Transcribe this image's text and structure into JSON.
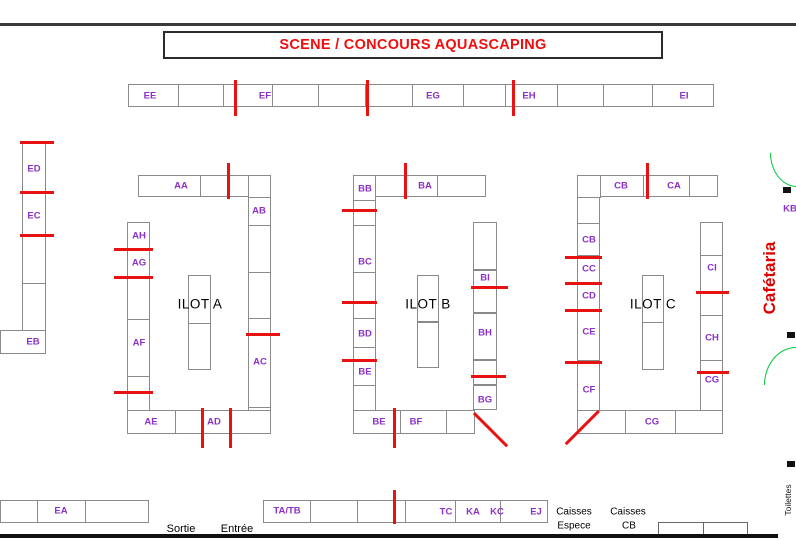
{
  "title": "SCENE / CONCOURS AQUASCAPING",
  "zones": {
    "ilot_a": "ILOT A",
    "ilot_b": "ILOT B",
    "ilot_c": "ILOT C",
    "cafetaria": "Cafétaria",
    "toilettes": "Toilettes",
    "sortie": "Sortie",
    "entree": "Entrée",
    "caisses_espece_line1": "Caisses",
    "caisses_espece_line2": "Espece",
    "caisses_cb_line1": "Caisses",
    "caisses_cb_line2": "CB"
  },
  "booths": {
    "ee": "EE",
    "ef": "EF",
    "eg": "EG",
    "eh": "EH",
    "ei": "EI",
    "ed": "ED",
    "ec": "EC",
    "eb": "EB",
    "ea": "EA",
    "ej": "EJ",
    "aa": "AA",
    "ab": "AB",
    "ac": "AC",
    "ad": "AD",
    "ae": "AE",
    "af": "AF",
    "ag": "AG",
    "ah": "AH",
    "ba": "BA",
    "bb": "BB",
    "bc": "BC",
    "bd": "BD",
    "be": "BE",
    "bf": "BF",
    "bg": "BG",
    "bh": "BH",
    "bi": "BI",
    "ca": "CA",
    "cb": "CB",
    "cc": "CC",
    "cd": "CD",
    "ce": "CE",
    "cf": "CF",
    "cg": "CG",
    "ch": "CH",
    "ci": "CI",
    "ka": "KA",
    "kb": "KB",
    "kc": "KC",
    "tatb": "TA/TB",
    "tc": "TC"
  },
  "colors": {
    "booth_label": "#8C30C8",
    "title_red": "#F10D0D",
    "marker_red": "#E81212",
    "door_green": "#00C83C",
    "wall_dark": "#3A3A3A",
    "cell_border": "#8A8A8A"
  }
}
